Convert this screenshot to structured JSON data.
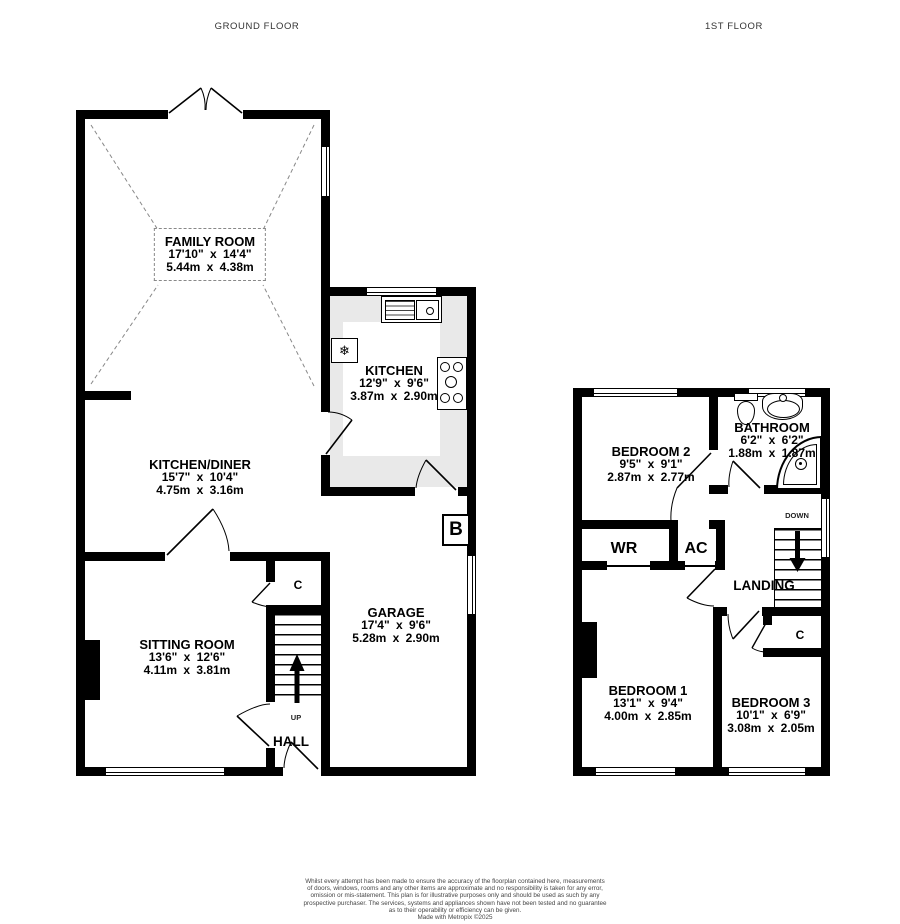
{
  "titles": {
    "ground": "GROUND FLOOR",
    "first": "1ST FLOOR"
  },
  "ground_floor": {
    "family_room": {
      "name": "FAMILY ROOM",
      "imperial": "17'10\" x 14'4\"",
      "metric": "5.44m x 4.38m"
    },
    "kitchen": {
      "name": "KITCHEN",
      "imperial": "12'9\" x 9'6\"",
      "metric": "3.87m x 2.90m"
    },
    "kitchen_diner": {
      "name": "KITCHEN/DINER",
      "imperial": "15'7\" x 10'4\"",
      "metric": "4.75m x 3.16m"
    },
    "sitting_room": {
      "name": "SITTING ROOM",
      "imperial": "13'6\" x 12'6\"",
      "metric": "4.11m x 3.81m"
    },
    "garage": {
      "name": "GARAGE",
      "imperial": "17'4\" x 9'6\"",
      "metric": "5.28m x 2.90m"
    },
    "hall_label": "HALL",
    "up_label": "UP",
    "cupboard_label": "C",
    "boiler_label": "B"
  },
  "first_floor": {
    "bedroom2": {
      "name": "BEDROOM 2",
      "imperial": "9'5\" x 9'1\"",
      "metric": "2.87m x 2.77m"
    },
    "bathroom": {
      "name": "BATHROOM",
      "imperial": "6'2\" x 6'2\"",
      "metric": "1.88m x 1.87m"
    },
    "bedroom1": {
      "name": "BEDROOM 1",
      "imperial": "13'1\" x 9'4\"",
      "metric": "4.00m x 2.85m"
    },
    "bedroom3": {
      "name": "BEDROOM 3",
      "imperial": "10'1\" x 6'9\"",
      "metric": "3.08m x 2.05m"
    },
    "wr_label": "WR",
    "ac_label": "AC",
    "landing_label": "LANDING",
    "down_label": "DOWN",
    "cupboard_label": "C"
  },
  "icons": {
    "freezer": "❄"
  },
  "footer": {
    "lines": [
      "Whilst every attempt has been made to ensure the accuracy of the floorplan contained here, measurements",
      "of doors, windows, rooms and any other items are approximate and no responsibility is taken for any error,",
      "omission or mis-statement. This plan is for illustrative purposes only and should be used as such by any",
      "prospective purchaser. The services, systems and appliances shown have not been tested and no guarantee",
      "as to their operability or efficiency can be given.",
      "Made with Metropix ©2025"
    ]
  }
}
